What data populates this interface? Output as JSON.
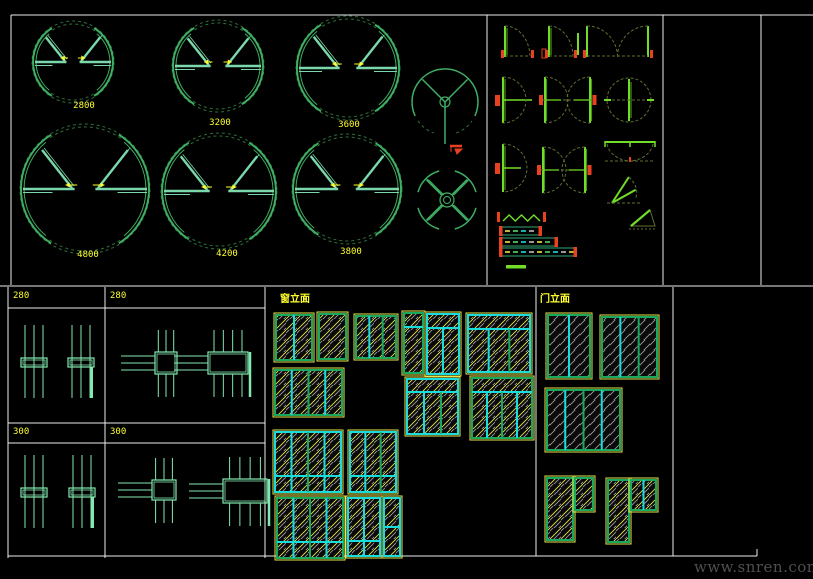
{
  "watermark": "www.snren.com",
  "colors": {
    "bg": "#000000",
    "line": "#ededed",
    "yellow": "#ffff2e",
    "ring_dark": "#2c7039",
    "ring_mid": "#3fae63",
    "teal": "#7bd8ab",
    "leaf": "#72dd29",
    "olive": "#5f7030",
    "red": "#e8411f",
    "cyan": "#19dcdc",
    "frame_green": "#18a95e",
    "hatch_gray": "#9b9b9b",
    "hatch_yellow": "#eae64b",
    "table_teal": "#82e8b0",
    "watermark": "#4f4f4f"
  },
  "revolving_panel": {
    "doors": [
      {
        "label": "2800",
        "cx": 73,
        "cy": 62,
        "r": 41,
        "lx": 84,
        "ly": 101
      },
      {
        "label": "3200",
        "cx": 218,
        "cy": 66,
        "r": 46,
        "lx": 220,
        "ly": 118
      },
      {
        "label": "3600",
        "cx": 348,
        "cy": 68,
        "r": 52,
        "lx": 349,
        "ly": 120
      },
      {
        "label": "4800",
        "cx": 85,
        "cy": 189,
        "r": 65,
        "lx": 88,
        "ly": 250
      },
      {
        "label": "4200",
        "cx": 219,
        "cy": 191,
        "r": 58,
        "lx": 227,
        "ly": 249
      },
      {
        "label": "3800",
        "cx": 347,
        "cy": 189,
        "r": 55,
        "lx": 351,
        "ly": 247
      }
    ],
    "three_wing": {
      "cx": 445,
      "cy": 102,
      "r": 33
    },
    "four_wing": {
      "cx": 447,
      "cy": 200,
      "r": 30
    },
    "red_mark": {
      "x": 450,
      "y": 146
    }
  },
  "details_table": {
    "cells": [
      {
        "label": "280"
      },
      {
        "label": "280"
      },
      {
        "label": "300"
      },
      {
        "label": "300"
      }
    ]
  },
  "window_elevations": {
    "title": "窗立面",
    "items": [
      {
        "x": 276,
        "y": 315,
        "w": 36,
        "h": 45,
        "cols": 2,
        "fc": "g"
      },
      {
        "x": 319,
        "y": 314,
        "w": 27,
        "h": 45,
        "cols": 1,
        "fc": "g"
      },
      {
        "x": 356,
        "y": 316,
        "w": 40,
        "h": 42,
        "cols": 3,
        "fc": "g"
      },
      {
        "x": 404,
        "y": 313,
        "w": 19,
        "h": 60,
        "cols": 1,
        "band": 14,
        "fc": "g"
      },
      {
        "x": 427,
        "y": 314,
        "w": 32,
        "h": 60,
        "cols": 2,
        "band": 14,
        "fc": "c"
      },
      {
        "x": 275,
        "y": 370,
        "w": 67,
        "h": 45,
        "cols": 4,
        "fc": "g"
      },
      {
        "x": 407,
        "y": 379,
        "w": 51,
        "h": 55,
        "cols": 3,
        "band": 13,
        "fc": "c"
      },
      {
        "x": 275,
        "y": 432,
        "w": 66,
        "h": 60,
        "cols": 4,
        "brow": 16,
        "fc": "c"
      },
      {
        "x": 350,
        "y": 432,
        "w": 46,
        "h": 60,
        "cols": 3,
        "brow": 16,
        "fc": "c"
      },
      {
        "x": 277,
        "y": 498,
        "w": 66,
        "h": 60,
        "cols": 4,
        "brow": 16,
        "fc": "g"
      },
      {
        "x": 348,
        "y": 498,
        "w": 32,
        "h": 58,
        "cols": 2,
        "brow": 15,
        "fc": "c"
      },
      {
        "x": 384,
        "y": 498,
        "w": 16,
        "h": 58,
        "cols": 1,
        "mid": 1,
        "fc": "c"
      },
      {
        "x": 468,
        "y": 315,
        "w": 62,
        "h": 57,
        "cols": 3,
        "band": 14,
        "fc": "c"
      },
      {
        "x": 472,
        "y": 378,
        "w": 60,
        "h": 60,
        "cols": 4,
        "band": 14,
        "fc": "g"
      }
    ]
  },
  "door_elevations": {
    "title": "门立面",
    "items": [
      {
        "x": 548,
        "y": 315,
        "w": 42,
        "h": 62,
        "cols": 2
      },
      {
        "x": 602,
        "y": 317,
        "w": 55,
        "h": 60,
        "cols": 3
      },
      {
        "x": 547,
        "y": 390,
        "w": 73,
        "h": 60,
        "cols": 4
      },
      {
        "x": 547,
        "y": 478,
        "w": 26,
        "h": 62,
        "cols": 1,
        "win": {
          "dx": 28,
          "dy": 0,
          "w": 18,
          "h": 32,
          "cols": 1
        }
      },
      {
        "x": 608,
        "y": 480,
        "w": 21,
        "h": 62,
        "cols": 1,
        "win": {
          "dx": 23,
          "dy": 0,
          "w": 25,
          "h": 30,
          "cols": 2
        }
      }
    ]
  },
  "plan_symbols": {
    "middle": [
      {
        "t": "sw",
        "x": 505,
        "y": 57,
        "l": 31,
        "r": 25
      },
      {
        "t": "sw",
        "x": 549,
        "y": 57,
        "l": 31,
        "r": 24,
        "sl": 29
      },
      {
        "t": "sw2",
        "x": 587,
        "x2": 648,
        "y": 57,
        "l": 31
      },
      {
        "t": "bs",
        "x": 503,
        "y": 100,
        "hh": 23,
        "lf": 29
      },
      {
        "t": "bs2",
        "x": 545,
        "x2": 590,
        "y": 100,
        "hh": 23
      },
      {
        "t": "cd",
        "x": 629,
        "y": 100,
        "r": 22
      },
      {
        "t": "bs",
        "x": 503,
        "y": 168,
        "hh": 24,
        "lf": 18
      },
      {
        "t": "bs2",
        "x": 543,
        "x2": 585,
        "y": 170,
        "hh": 23
      },
      {
        "t": "rd",
        "x": 605,
        "y": 141,
        "w": 50,
        "h": 20
      },
      {
        "t": "cn",
        "x": 610,
        "y": 179,
        "w": 27,
        "h": 24
      },
      {
        "t": "zz",
        "x": 503,
        "y": 219,
        "w": 37
      },
      {
        "t": "sb",
        "x": 500,
        "y": 227,
        "w": 41
      },
      {
        "t": "sb",
        "x": 500,
        "y": 238,
        "w": 57
      },
      {
        "t": "sb",
        "x": 500,
        "y": 248,
        "w": 76
      },
      {
        "t": "tl",
        "x": 506,
        "y": 265,
        "w": 20
      },
      {
        "t": "tr",
        "x": 631,
        "y": 210,
        "w": 24,
        "h": 16
      },
      {
        "t": "qd",
        "x": 628,
        "y": 233,
        "w": 27,
        "h": 11
      },
      {
        "t": "hl",
        "x": 600,
        "y": 244,
        "w": 26
      },
      {
        "t": "sb",
        "x": 593,
        "y": 255,
        "w": 50
      },
      {
        "t": "sb",
        "x": 593,
        "y": 270,
        "w": 48
      }
    ],
    "right": [
      {
        "t": "tr",
        "x": 668,
        "y": 22,
        "w": 28,
        "h": 15
      },
      {
        "t": "tr",
        "x": 700,
        "y": 22,
        "w": 28,
        "h": 15
      },
      {
        "t": "tr2",
        "x": 732,
        "y": 22,
        "w": 26,
        "h": 15
      },
      {
        "t": "vp",
        "x": 670,
        "y": 38,
        "w": 74,
        "h": 17
      },
      {
        "t": "bs2",
        "x": 671,
        "x2": 694,
        "y": 87,
        "hh": 18,
        "s": 1
      },
      {
        "t": "bs2",
        "x": 704,
        "x2": 744,
        "y": 87,
        "hh": 18,
        "s": 1
      },
      {
        "t": "bs2",
        "x": 670,
        "x2": 693,
        "y": 135,
        "hh": 17,
        "s": 1
      },
      {
        "t": "bs2",
        "x": 706,
        "x2": 732,
        "y": 135,
        "hh": 17,
        "s": 1
      },
      {
        "t": "trA",
        "x": 678,
        "y": 168,
        "w": 22,
        "h": 19
      },
      {
        "t": "trA",
        "x": 711,
        "y": 168,
        "w": 22,
        "h": 19
      },
      {
        "t": "vp",
        "x": 686,
        "y": 188,
        "w": 40,
        "h": 17
      },
      {
        "t": "la",
        "x": 691,
        "y": 210,
        "w": 20,
        "h": 16
      },
      {
        "t": "qt",
        "x": 683,
        "y": 238,
        "w": 26,
        "h": 27,
        "side": "r"
      }
    ],
    "far_right": [
      {
        "t": "sw",
        "x": 768,
        "y": 53,
        "l": 31,
        "r": 26
      },
      {
        "t": "sw",
        "x": 811,
        "y": 53,
        "l": 31,
        "r": 20
      },
      {
        "t": "bs",
        "x": 771,
        "y": 95,
        "hh": 27,
        "lf": 30
      },
      {
        "t": "bs",
        "x": 772,
        "y": 168,
        "hh": 21,
        "lf": 36
      },
      {
        "t": "bs",
        "x": 812,
        "y": 168,
        "hh": 21,
        "lf": 10
      },
      {
        "t": "qt",
        "x": 771,
        "y": 211,
        "w": 26,
        "h": 26,
        "side": "l"
      }
    ]
  }
}
